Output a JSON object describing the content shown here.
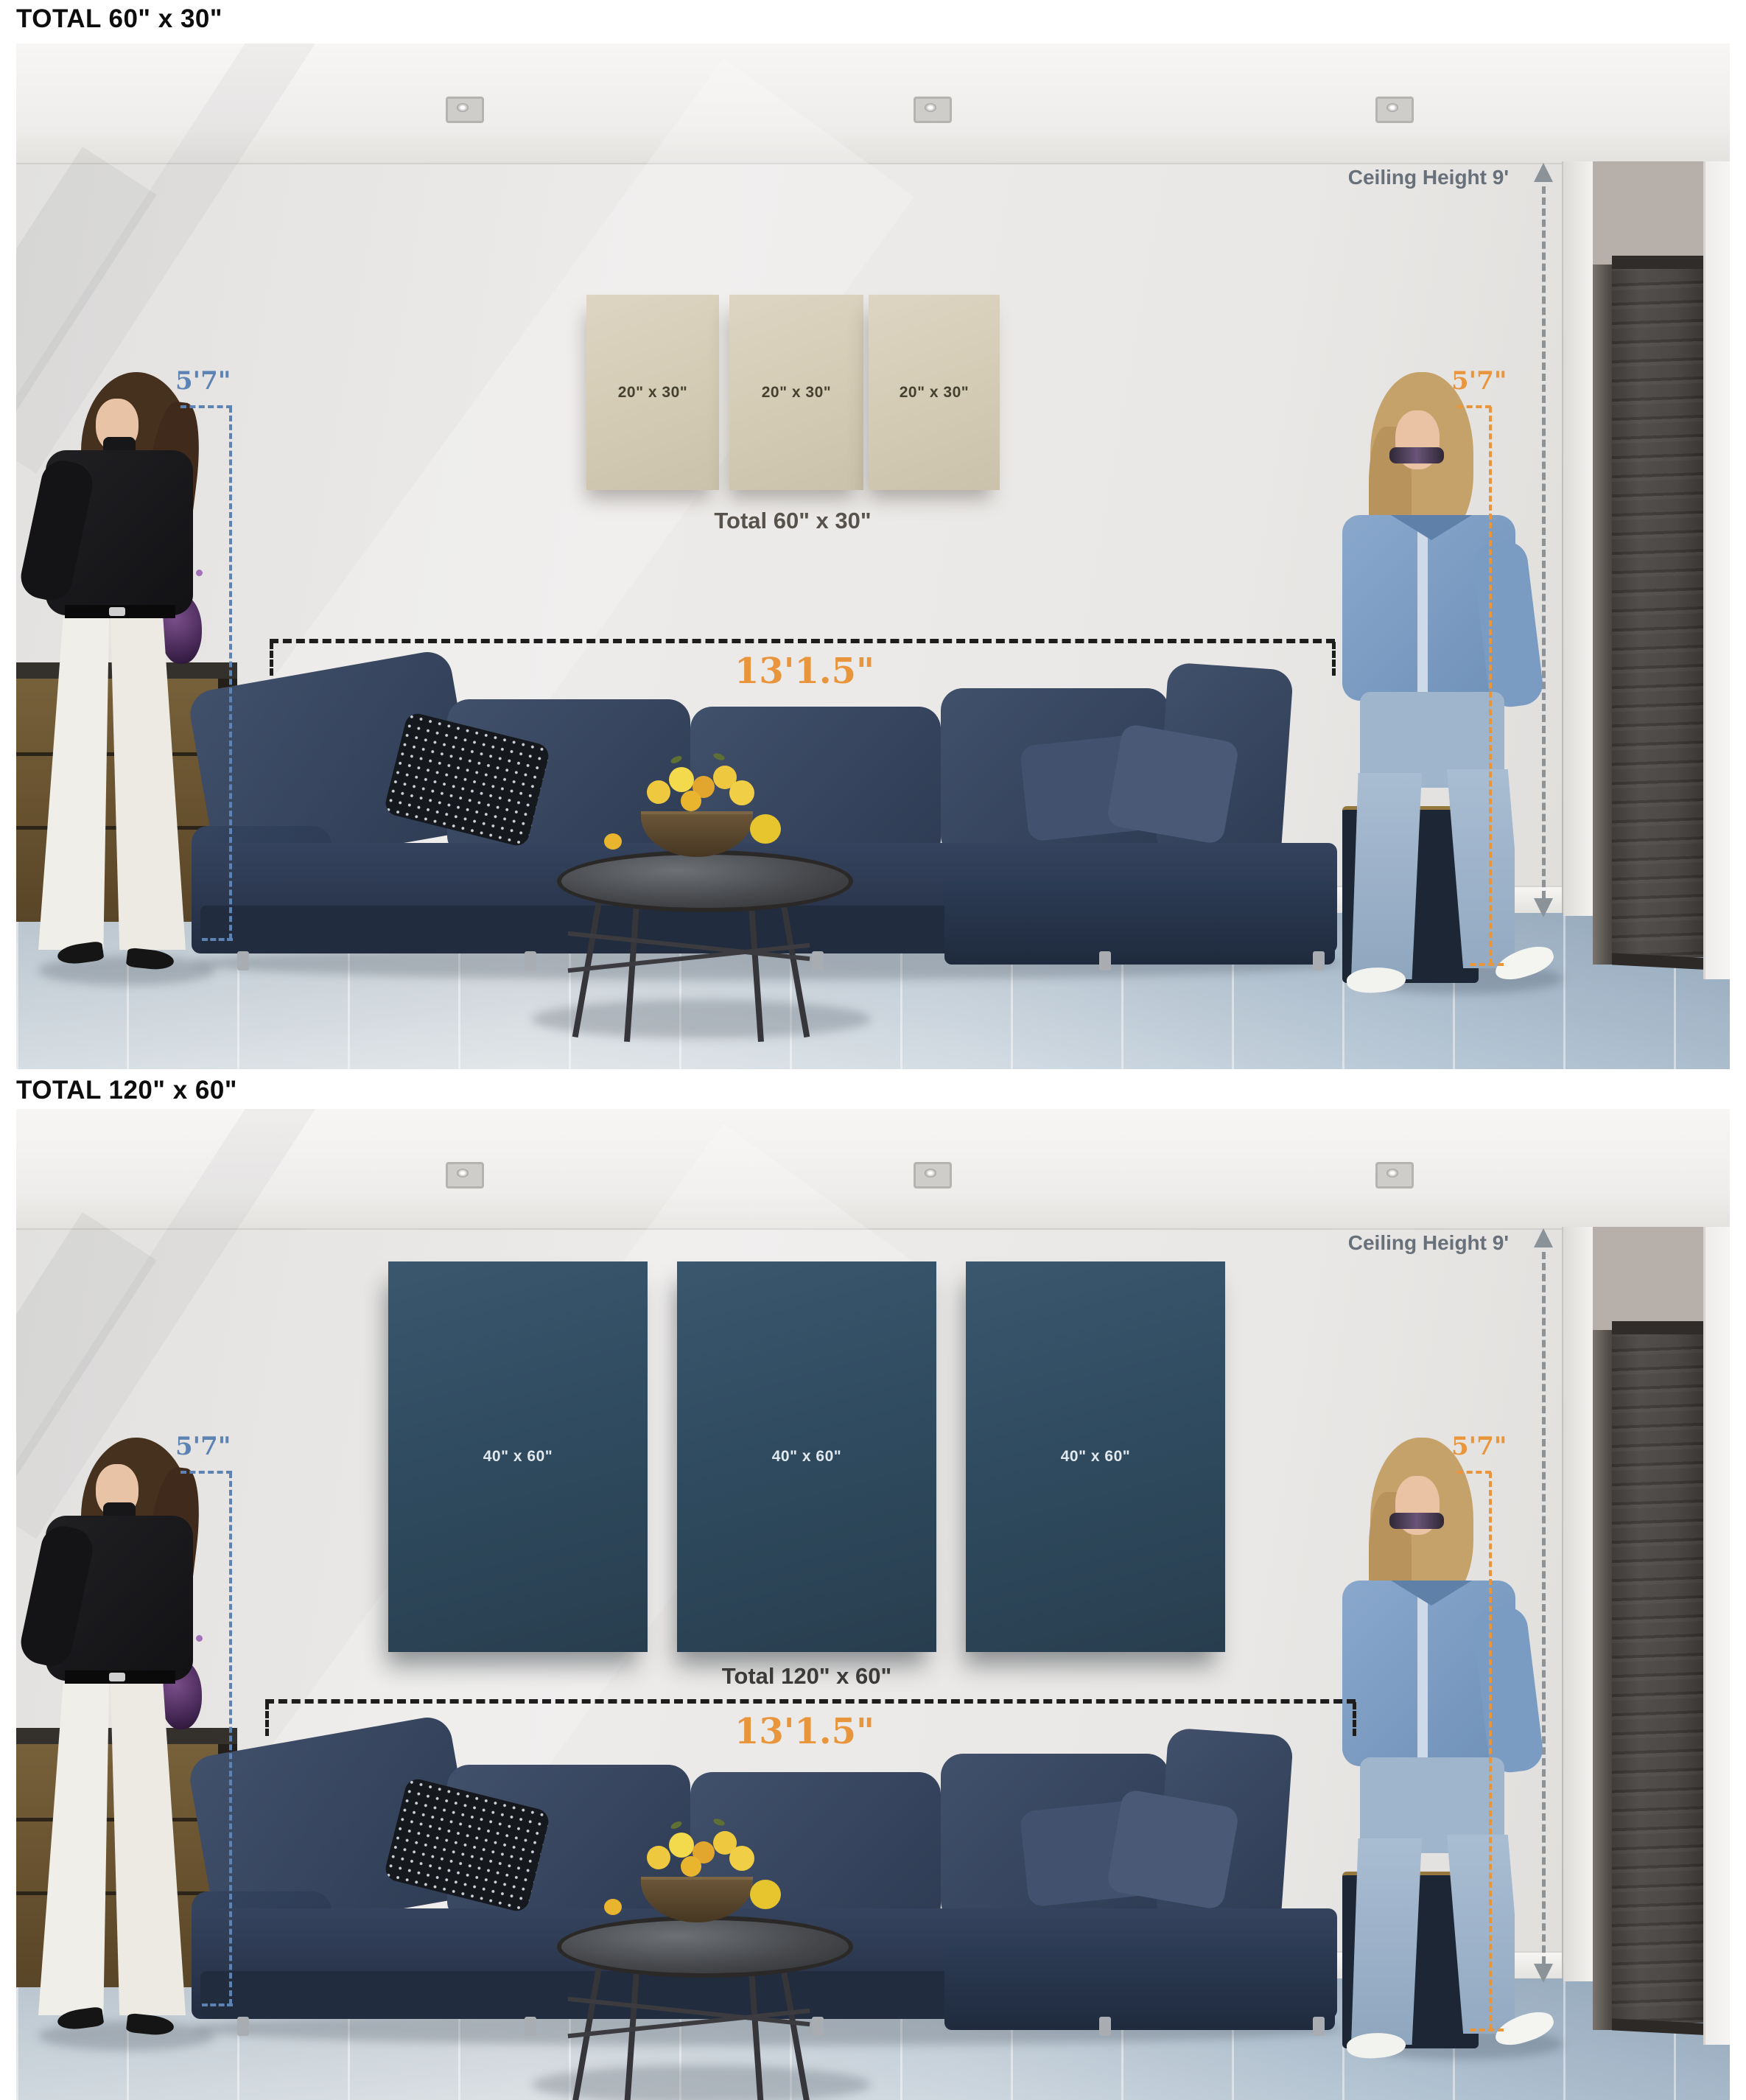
{
  "sections": [
    {
      "title": "TOTAL 60\" x 30\"",
      "ceiling_label": "Ceiling Height 9'",
      "left_height_label": "5'7\"",
      "right_height_label": "5'7\"",
      "width_label": "13'1.5\"",
      "panels": [
        {
          "label": "20\" x 30\""
        },
        {
          "label": "20\" x 30\""
        },
        {
          "label": "20\" x 30\""
        }
      ],
      "total_label": "Total 60\" x 30\""
    },
    {
      "title": "TOTAL 120\" x 60\"",
      "ceiling_label": "Ceiling Height 9'",
      "left_height_label": "5'7\"",
      "right_height_label": "5'7\"",
      "width_label": "13'1.5\"",
      "panels": [
        {
          "label": "40\" x 60\""
        },
        {
          "label": "40\" x 60\""
        },
        {
          "label": "40\" x 60\""
        }
      ],
      "total_label": "Total 120\" x 60\""
    }
  ],
  "colors": {
    "accent_orange": "#e8953c",
    "accent_blue": "#5c83b3",
    "guide_gray": "#8b9298",
    "dimension_black": "#1d1d1d",
    "canvas_beige": "#d6ceba",
    "canvas_teal": "#2f4a5c",
    "sofa_navy": "#33415c",
    "floor_bluegray": "#c2cfd9"
  },
  "icons": [
    "arrow-up-icon",
    "arrow-down-icon"
  ]
}
